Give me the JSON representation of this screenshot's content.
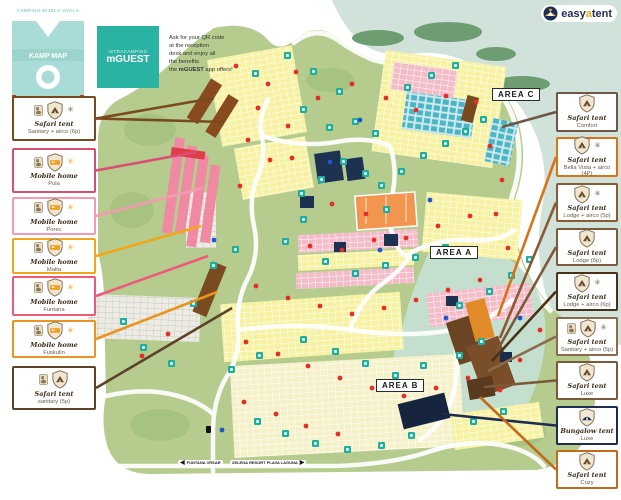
{
  "header": {
    "logo": {
      "title": "CAMPING BIJELA UVALA",
      "subtitle": "KAMP MAP"
    },
    "promo": {
      "brand_top": "ISTRACAMPING",
      "brand": "mGUEST",
      "lines": [
        "Ask for your QR code",
        "at the reception",
        "desk and enjoy all",
        "the benefits"
      ],
      "last_line_pre": "the ",
      "last_line_brand": "mGUEST",
      "last_line_post": " app offers!"
    },
    "easyatent": {
      "part1": "easy",
      "part2": "a",
      "part3": "tent"
    }
  },
  "map": {
    "areas": [
      {
        "label": "AREA A"
      },
      {
        "label": "AREA B"
      },
      {
        "label": "AREA C"
      }
    ],
    "road_signs": {
      "left": "FUNTANA VRSAR",
      "right": "ZELENA RESORT PLAVA LAGUNA"
    },
    "colors": {
      "land": "#b6cc8f",
      "water": "#d0e2da",
      "pitch_yellow": "#f7f2a2",
      "pitch_pink": "#f3bcc8",
      "facility_teal": "#1fae9e",
      "alert_red": "#e23028",
      "building_navy": "#1d3150",
      "promo_teal": "#2ab3a3",
      "easyatent_navy": "#1f2d5c",
      "easyatent_yellow": "#f0a818"
    }
  },
  "legend_left": [
    {
      "type": "Safari tent",
      "name": "Sanitary + airco (6p)",
      "color": "#7a4a1f",
      "glyph": "tent",
      "sanitary": true,
      "airco": true
    },
    {
      "type": "Mobile home",
      "name": "Pula",
      "color": "#d94f70",
      "glyph": "mobile",
      "sanitary": true,
      "airco": true
    },
    {
      "type": "Mobile home",
      "name": "Porec",
      "color": "#f49ab1",
      "glyph": "mobile",
      "sanitary": true,
      "airco": true
    },
    {
      "type": "Mobile home",
      "name": "Malta",
      "color": "#f2a71b",
      "glyph": "mobile",
      "sanitary": true,
      "airco": true
    },
    {
      "type": "Mobile home",
      "name": "Funtana",
      "color": "#ee5a7c",
      "glyph": "mobile",
      "sanitary": true,
      "airco": true
    },
    {
      "type": "Mobile home",
      "name": "Fuskulin",
      "color": "#e89420",
      "glyph": "mobile",
      "sanitary": true,
      "airco": true
    },
    {
      "type": "Safari tent",
      "name": "sanitary (5p)",
      "color": "#5d4228",
      "glyph": "tent",
      "sanitary": true,
      "airco": false
    }
  ],
  "legend_right": [
    {
      "type": "Safari tent",
      "name": "Comfort",
      "color": "#6b5744",
      "glyph": "tent",
      "sanitary": false,
      "airco": false
    },
    {
      "type": "Safari tent",
      "name": "Bella Vista + airco (4P)",
      "color": "#d9731a",
      "glyph": "tent",
      "sanitary": false,
      "airco": true
    },
    {
      "type": "Safari tent",
      "name": "Lodge + airco (5p)",
      "color": "#8a5a33",
      "glyph": "tent",
      "sanitary": false,
      "airco": true
    },
    {
      "type": "Safari tent",
      "name": "Lodge (6p)",
      "color": "#7d5a3c",
      "glyph": "tent",
      "sanitary": false,
      "airco": false
    },
    {
      "type": "Safari tent",
      "name": "Lodge + airco (6p)",
      "color": "#4a3018",
      "glyph": "tent",
      "sanitary": false,
      "airco": true
    },
    {
      "type": "Safari tent",
      "name": "Sanitary + airco (5p)",
      "color": "#8a6a4a",
      "glyph": "tent",
      "sanitary": true,
      "airco": true
    },
    {
      "type": "Safari tent",
      "name": "Luxe",
      "color": "#7a5a3a",
      "glyph": "tent",
      "sanitary": false,
      "airco": false
    },
    {
      "type": "Bungalow tent",
      "name": "Luxe",
      "color": "#1e2d4f",
      "glyph": "bungalow",
      "sanitary": false,
      "airco": false
    },
    {
      "type": "Safari tent",
      "name": "Cozy",
      "color": "#c56a1b",
      "glyph": "tent",
      "sanitary": false,
      "airco": false
    }
  ]
}
